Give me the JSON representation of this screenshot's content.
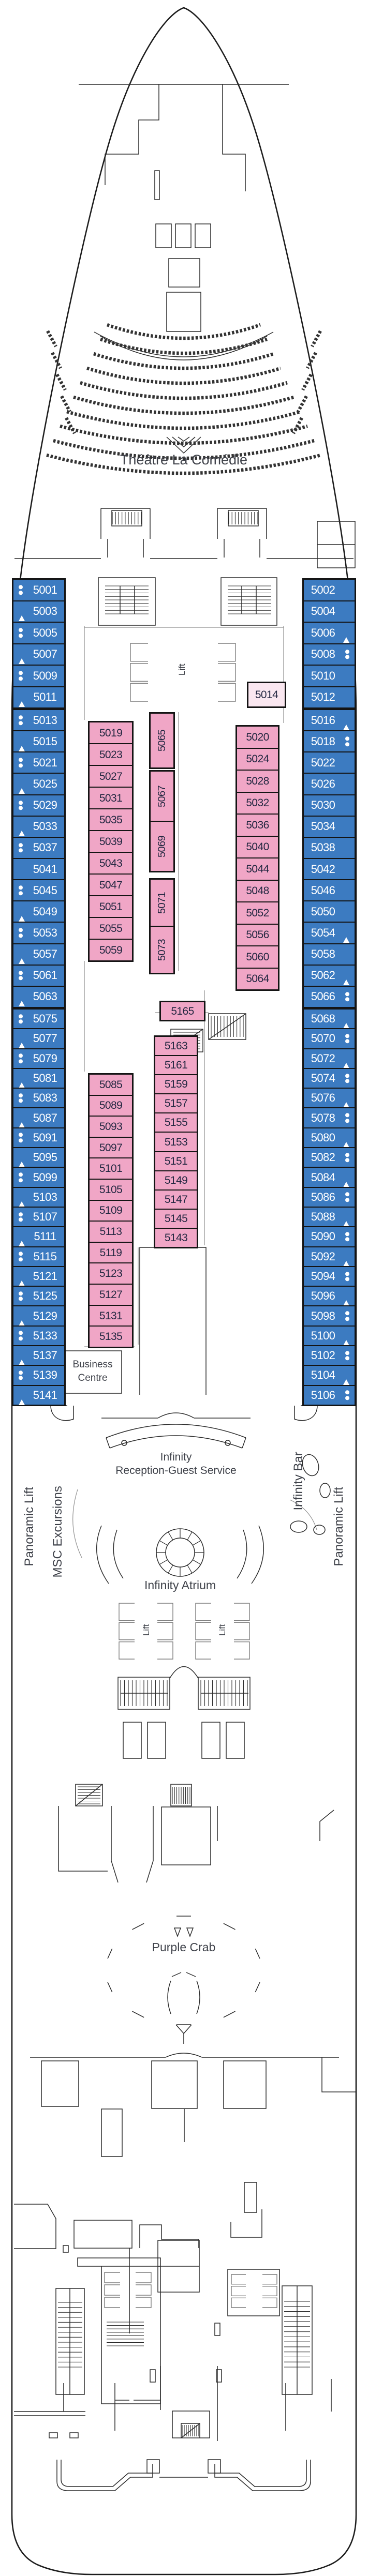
{
  "labels": {
    "theatre": "Théâtre La Comédie",
    "business_line1": "Business",
    "business_line2": "Centre",
    "reception_line1": "Infinity",
    "reception_line2": "Reception-Guest Service",
    "atrium": "Infinity Atrium",
    "purple_crab": "Purple Crab",
    "lift": "Lift",
    "panoramic_lift": "Panoramic Lift",
    "msc_excursions": "MSC Excursions",
    "infinity_bar": "Infinity Bar"
  },
  "colors": {
    "cabin_blue": "#3C7BC1",
    "cabin_pink": "#F0A6C6",
    "cabin_pink_light": "#FAE7F0",
    "cabin_border": "#141414",
    "blue_cabin_text": "#FFFFFF",
    "pink_cabin_text": "#232741",
    "label_text": "#3E4149",
    "line_dark": "#2B2B2B",
    "line_gray": "#909090"
  },
  "cabin_columns": [
    {
      "id": "port",
      "groups": [
        [
          [
            "5001",
            "dots"
          ],
          [
            "5003",
            "tri"
          ],
          [
            "5005",
            "dots"
          ],
          [
            "5007",
            "tri"
          ],
          [
            "5009",
            "dots"
          ],
          [
            "5011",
            "tri"
          ]
        ],
        [
          [
            "5013",
            "dots"
          ],
          [
            "5015",
            "tri"
          ],
          [
            "5021",
            "dots"
          ],
          [
            "5025",
            "tri"
          ],
          [
            "5029",
            "dots"
          ],
          [
            "5033",
            "tri"
          ],
          [
            "5037",
            "dots"
          ],
          [
            "5041",
            ""
          ],
          [
            "5045",
            "dots"
          ],
          [
            "5049",
            "tri"
          ],
          [
            "5053",
            "dots"
          ],
          [
            "5057",
            "tri"
          ],
          [
            "5061",
            "dots"
          ],
          [
            "5063",
            "tri"
          ]
        ],
        [
          [
            "5075",
            "dots"
          ],
          [
            "5077",
            "tri"
          ],
          [
            "5079",
            "dots"
          ],
          [
            "5081",
            "tri"
          ],
          [
            "5083",
            "dots"
          ],
          [
            "5087",
            "tri"
          ],
          [
            "5091",
            "dots"
          ],
          [
            "5095",
            "tri"
          ],
          [
            "5099",
            "dots"
          ],
          [
            "5103",
            "tri"
          ],
          [
            "5107",
            "dots"
          ],
          [
            "5111",
            "tri"
          ],
          [
            "5115",
            "dots"
          ],
          [
            "5121",
            "tri"
          ],
          [
            "5125",
            "dots"
          ],
          [
            "5129",
            "tri"
          ],
          [
            "5133",
            "dots"
          ],
          [
            "5137",
            "tri"
          ],
          [
            "5139",
            "dots"
          ],
          [
            "5141",
            "tri"
          ]
        ]
      ]
    },
    {
      "id": "starboard",
      "groups": [
        [
          [
            "5002",
            ""
          ],
          [
            "5004",
            ""
          ],
          [
            "5006",
            "tri"
          ],
          [
            "5008",
            "dots"
          ],
          [
            "5010",
            ""
          ],
          [
            "5012",
            ""
          ]
        ],
        [
          [
            "5016",
            "tri"
          ],
          [
            "5018",
            "dots"
          ],
          [
            "5022",
            ""
          ],
          [
            "5026",
            ""
          ],
          [
            "5030",
            ""
          ],
          [
            "5034",
            ""
          ],
          [
            "5038",
            ""
          ],
          [
            "5042",
            ""
          ],
          [
            "5046",
            ""
          ],
          [
            "5050",
            ""
          ],
          [
            "5054",
            "tri"
          ],
          [
            "5058",
            ""
          ],
          [
            "5062",
            "tri"
          ],
          [
            "5066",
            "dots"
          ]
        ],
        [
          [
            "5068",
            "tri"
          ],
          [
            "5070",
            "dots"
          ],
          [
            "5072",
            "tri"
          ],
          [
            "5074",
            "dots"
          ],
          [
            "5076",
            "tri"
          ],
          [
            "5078",
            "dots"
          ],
          [
            "5080",
            "tri"
          ],
          [
            "5082",
            "dots"
          ],
          [
            "5084",
            "tri"
          ],
          [
            "5086",
            "dots"
          ],
          [
            "5088",
            "tri"
          ],
          [
            "5090",
            "dots"
          ],
          [
            "5092",
            "tri"
          ],
          [
            "5094",
            "dots"
          ],
          [
            "5096",
            "tri"
          ],
          [
            "5098",
            "dots"
          ],
          [
            "5100",
            "tri"
          ],
          [
            "5102",
            "dots"
          ],
          [
            "5104",
            "tri"
          ],
          [
            "5106",
            "dots"
          ]
        ]
      ]
    },
    {
      "id": "mid-forward-port",
      "groups": [
        [
          [
            "5019",
            ""
          ],
          [
            "5023",
            ""
          ],
          [
            "5027",
            ""
          ],
          [
            "5031",
            ""
          ],
          [
            "5035",
            ""
          ],
          [
            "5039",
            ""
          ],
          [
            "5043",
            ""
          ],
          [
            "5047",
            ""
          ],
          [
            "5051",
            ""
          ],
          [
            "5055",
            ""
          ],
          [
            "5059",
            ""
          ]
        ]
      ]
    },
    {
      "id": "cabin-5014",
      "groups": [
        [
          [
            "5014",
            ""
          ]
        ]
      ]
    },
    {
      "id": "mid-forward-starboard",
      "groups": [
        [
          [
            "5020",
            ""
          ],
          [
            "5024",
            ""
          ],
          [
            "5028",
            ""
          ],
          [
            "5032",
            ""
          ],
          [
            "5036",
            ""
          ],
          [
            "5040",
            ""
          ],
          [
            "5044",
            ""
          ],
          [
            "5048",
            ""
          ],
          [
            "5052",
            ""
          ],
          [
            "5056",
            ""
          ],
          [
            "5060",
            ""
          ],
          [
            "5064",
            ""
          ]
        ]
      ]
    },
    {
      "id": "mid-forward-vertical",
      "groups": [
        [
          [
            "5065",
            ""
          ]
        ],
        [
          [
            "5067",
            ""
          ],
          [
            "5069",
            ""
          ]
        ],
        [
          [
            "5071",
            ""
          ],
          [
            "5073",
            ""
          ]
        ]
      ]
    },
    {
      "id": "mid-aft-port",
      "groups": [
        [
          [
            "5085",
            ""
          ],
          [
            "5089",
            ""
          ],
          [
            "5093",
            ""
          ],
          [
            "5097",
            ""
          ],
          [
            "5101",
            ""
          ],
          [
            "5105",
            ""
          ],
          [
            "5109",
            ""
          ],
          [
            "5113",
            ""
          ],
          [
            "5119",
            ""
          ],
          [
            "5123",
            ""
          ],
          [
            "5127",
            ""
          ],
          [
            "5131",
            ""
          ],
          [
            "5135",
            ""
          ]
        ]
      ]
    },
    {
      "id": "cabin-5165",
      "groups": [
        [
          [
            "5165",
            ""
          ]
        ]
      ]
    },
    {
      "id": "mid-aft-starboard",
      "groups": [
        [
          [
            "5163",
            ""
          ],
          [
            "5161",
            ""
          ],
          [
            "5159",
            ""
          ],
          [
            "5157",
            ""
          ],
          [
            "5155",
            ""
          ],
          [
            "5153",
            ""
          ],
          [
            "5151",
            ""
          ],
          [
            "5149",
            ""
          ],
          [
            "5147",
            ""
          ],
          [
            "5145",
            ""
          ],
          [
            "5143",
            ""
          ]
        ]
      ]
    }
  ]
}
